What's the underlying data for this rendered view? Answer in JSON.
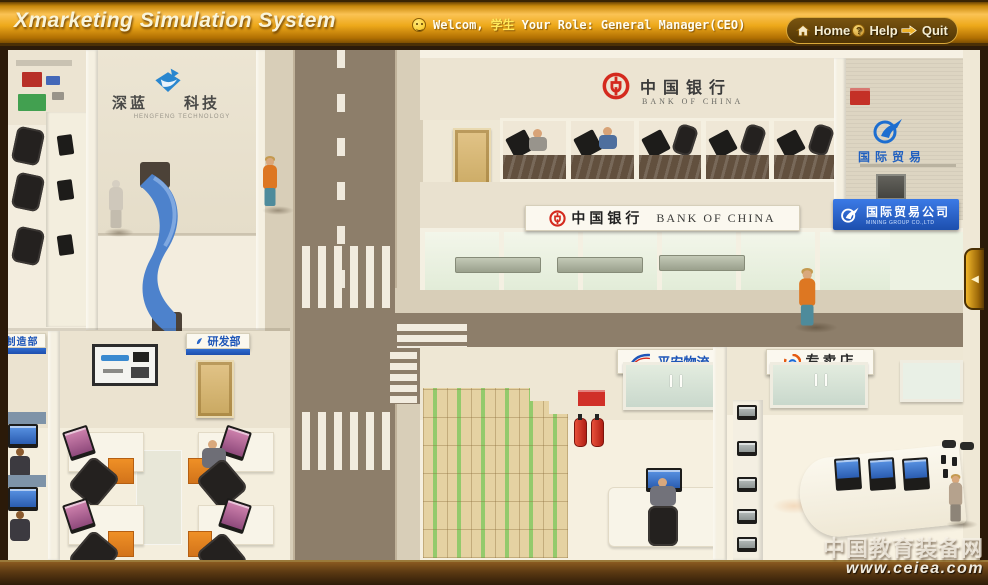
{
  "header": {
    "title": "Xmarketing Simulation System",
    "welcome_prefix": "Welcom,",
    "welcome_user": "学生",
    "role_label": "Your Role:",
    "role_value": "General Manager(CEO)",
    "nav": {
      "home": "Home",
      "help": "Help",
      "quit": "Quit"
    }
  },
  "buildings": {
    "tech": {
      "name_left": "深蓝",
      "name_right": "科技",
      "subtitle": "HENGFENG TECHNOLOGY"
    },
    "bank": {
      "name": "中国银行",
      "subtitle": "BANK OF CHINA"
    },
    "trade": {
      "wall_name": "国际贸易",
      "sign_name": "国际贸易公司",
      "sign_subtitle": "MINING GROUP CO.,LTD"
    },
    "logistics": {
      "name": "平安物流",
      "logo_text": "ANHLA"
    },
    "store": {
      "name": "专卖店"
    },
    "manufacturing": {
      "name": "制造部"
    },
    "rnd": {
      "name": "研发部"
    }
  },
  "watermark": {
    "site_name": "中国教育装备网",
    "site_url": "www.ceiea.com"
  },
  "colors": {
    "header_gold": "#e8a519",
    "bank_red": "#d42a1e",
    "sign_blue": "#1d4fae",
    "road_brown": "#8d7e6a",
    "accent_orange": "#e0801e"
  }
}
